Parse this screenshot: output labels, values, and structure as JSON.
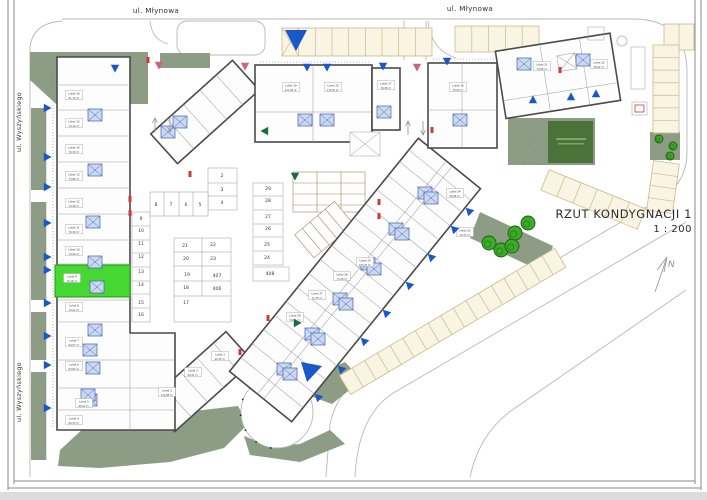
{
  "title": {
    "text": "RZUT KONDYGNACJI 1",
    "scale": "1 : 200"
  },
  "north_label": "N",
  "streets": {
    "top": [
      "ul. Młynowa",
      "ul. Młynowa"
    ],
    "left": [
      "ul. Wyszyńskiego",
      "ul. Wyszyńskiego"
    ]
  },
  "colors": {
    "accent_blue": "#1a57c8",
    "highlight_green": "#46d832",
    "sage_green": "#8d9c84",
    "parking_cream": "#faf5e2",
    "marker_pink": "#c9628f",
    "marker_dark_green": "#1b6b40",
    "door_red": "#d03a30"
  },
  "parking": {
    "numbers": [
      {
        "n": "2",
        "x": 222,
        "y": 177
      },
      {
        "n": "3",
        "x": 222,
        "y": 191
      },
      {
        "n": "4",
        "x": 222,
        "y": 204
      },
      {
        "n": "5",
        "x": 200,
        "y": 206
      },
      {
        "n": "6",
        "x": 186,
        "y": 206
      },
      {
        "n": "7",
        "x": 171,
        "y": 206
      },
      {
        "n": "8",
        "x": 156,
        "y": 206
      },
      {
        "n": "9",
        "x": 141,
        "y": 220
      },
      {
        "n": "10",
        "x": 141,
        "y": 232
      },
      {
        "n": "11",
        "x": 141,
        "y": 245
      },
      {
        "n": "12",
        "x": 141,
        "y": 258
      },
      {
        "n": "13",
        "x": 141,
        "y": 273
      },
      {
        "n": "14",
        "x": 141,
        "y": 286
      },
      {
        "n": "15",
        "x": 141,
        "y": 304
      },
      {
        "n": "16",
        "x": 141,
        "y": 316
      },
      {
        "n": "17",
        "x": 186,
        "y": 304
      },
      {
        "n": "18",
        "x": 186,
        "y": 289
      },
      {
        "n": "19",
        "x": 187,
        "y": 276
      },
      {
        "n": "20",
        "x": 186,
        "y": 260
      },
      {
        "n": "21",
        "x": 185,
        "y": 247
      },
      {
        "n": "22",
        "x": 213,
        "y": 246
      },
      {
        "n": "23",
        "x": 213,
        "y": 260
      },
      {
        "n": "24",
        "x": 267,
        "y": 259
      },
      {
        "n": "25",
        "x": 267,
        "y": 246
      },
      {
        "n": "26",
        "x": 268,
        "y": 230
      },
      {
        "n": "27",
        "x": 268,
        "y": 218
      },
      {
        "n": "28",
        "x": 268,
        "y": 202
      },
      {
        "n": "29",
        "x": 268,
        "y": 190
      },
      {
        "n": "406",
        "x": 217,
        "y": 290
      },
      {
        "n": "407",
        "x": 217,
        "y": 277
      },
      {
        "n": "408",
        "x": 270,
        "y": 275
      }
    ]
  },
  "unit_labels": [
    {
      "name": "Lokal 16",
      "area": "81,74 m²",
      "x": 74,
      "y": 96
    },
    {
      "name": "Lokal 15",
      "area": "70,16 m²",
      "x": 74,
      "y": 124
    },
    {
      "name": "Lokal 14",
      "area": "70,30 m²",
      "x": 74,
      "y": 150
    },
    {
      "name": "Lokal 13",
      "area": "73,86 m²",
      "x": 74,
      "y": 177
    },
    {
      "name": "Lokal 12",
      "area": "70,26 m²",
      "x": 74,
      "y": 204
    },
    {
      "name": "Lokal 11",
      "area": "70,30 m²",
      "x": 74,
      "y": 230
    },
    {
      "name": "Lokal 10",
      "area": "70,26 m²",
      "x": 74,
      "y": 252
    },
    {
      "name": "Lokal 9",
      "area": "70,16 m²",
      "x": 72,
      "y": 279
    },
    {
      "name": "Lokal 8",
      "area": "70,21 m²",
      "x": 74,
      "y": 308
    },
    {
      "name": "Lokal 7",
      "area": "64,07 m²",
      "x": 74,
      "y": 343
    },
    {
      "name": "Lokal 6",
      "area": "63,81 m²",
      "x": 74,
      "y": 367
    },
    {
      "name": "Lokal 5",
      "area": "98,22 m²",
      "x": 84,
      "y": 404
    },
    {
      "name": "Lokal 4",
      "area": "66,33 m²",
      "x": 74,
      "y": 421
    },
    {
      "name": "Lokal 1",
      "area": "112,88 m²",
      "x": 167,
      "y": 393
    },
    {
      "name": "Lokal 2",
      "area": "92,91 m²",
      "x": 193,
      "y": 373
    },
    {
      "name": "Lokal 3",
      "area": "90,15 m²",
      "x": 220,
      "y": 357
    },
    {
      "name": "Lokal 26",
      "area": "59,84 m²",
      "x": 295,
      "y": 318
    },
    {
      "name": "Lokal 27",
      "area": "71,35 m²",
      "x": 317,
      "y": 296
    },
    {
      "name": "Lokal 28",
      "area": "73,16 m²",
      "x": 342,
      "y": 277
    },
    {
      "name": "Lokal 29",
      "area": "103,97 m²",
      "x": 365,
      "y": 263
    },
    {
      "name": "Lokal 23",
      "area": "22,71 m²",
      "x": 465,
      "y": 233
    },
    {
      "name": "Lokal 24",
      "area": "40,96 m²",
      "x": 455,
      "y": 194
    },
    {
      "name": "Lokal 19",
      "area": "127,04 m²",
      "x": 291,
      "y": 88
    },
    {
      "name": "Lokal 20",
      "area": "132,87 m²",
      "x": 333,
      "y": 88
    },
    {
      "name": "Lokal 17",
      "area": "34,36 m²",
      "x": 386,
      "y": 86
    },
    {
      "name": "Lokal 18",
      "area": "75,50 m²",
      "x": 458,
      "y": 88
    },
    {
      "name": "Lokal 21",
      "area": "74,08 m²",
      "x": 542,
      "y": 67
    },
    {
      "name": "Lokal 22",
      "area": "58,92 m²",
      "x": 599,
      "y": 65
    }
  ],
  "markers": {
    "blue_triangles": [
      {
        "x": 47,
        "y": 108,
        "rot": -90
      },
      {
        "x": 47,
        "y": 157,
        "rot": -90
      },
      {
        "x": 47,
        "y": 187,
        "rot": -90
      },
      {
        "x": 47,
        "y": 223,
        "rot": -90
      },
      {
        "x": 47,
        "y": 257,
        "rot": -90
      },
      {
        "x": 47,
        "y": 270,
        "rot": -90
      },
      {
        "x": 47,
        "y": 303,
        "rot": -90
      },
      {
        "x": 47,
        "y": 336,
        "rot": -90
      },
      {
        "x": 47,
        "y": 365,
        "rot": -90
      },
      {
        "x": 47,
        "y": 408,
        "rot": -90
      },
      {
        "x": 115,
        "y": 68,
        "rot": 0
      },
      {
        "x": 307,
        "y": 67,
        "rot": 0
      },
      {
        "x": 327,
        "y": 67,
        "rot": 0
      },
      {
        "x": 383,
        "y": 66,
        "rot": 0
      },
      {
        "x": 447,
        "y": 61,
        "rot": 0
      },
      {
        "x": 533,
        "y": 100,
        "rot": 180
      },
      {
        "x": 571,
        "y": 97,
        "rot": 180
      },
      {
        "x": 596,
        "y": 94,
        "rot": 180
      },
      {
        "x": 469,
        "y": 211,
        "rot": 135
      },
      {
        "x": 454,
        "y": 229,
        "rot": 135
      },
      {
        "x": 431,
        "y": 257,
        "rot": 135
      },
      {
        "x": 409,
        "y": 285,
        "rot": 135
      },
      {
        "x": 386,
        "y": 313,
        "rot": 135
      },
      {
        "x": 364,
        "y": 341,
        "rot": 135
      },
      {
        "x": 341,
        "y": 369,
        "rot": 135
      },
      {
        "x": 318,
        "y": 397,
        "rot": 135
      }
    ],
    "pink_triangles": [
      {
        "x": 159,
        "y": 65,
        "rot": 0
      },
      {
        "x": 245,
        "y": 66,
        "rot": 0
      },
      {
        "x": 417,
        "y": 67,
        "rot": 0
      }
    ],
    "green_triangles": [
      {
        "x": 265,
        "y": 131,
        "rot": 90
      },
      {
        "x": 295,
        "y": 176,
        "rot": 0
      },
      {
        "x": 297,
        "y": 323,
        "rot": -90
      }
    ],
    "solid_triangles": [
      {
        "pts": "285,30 307,30 296,51"
      },
      {
        "pts": "301,362 322,366 307,382"
      }
    ]
  },
  "trees": [
    {
      "x": 489,
      "y": 243,
      "r": 7
    },
    {
      "x": 501,
      "y": 250,
      "r": 7
    },
    {
      "x": 512,
      "y": 246,
      "r": 7
    },
    {
      "x": 515,
      "y": 233,
      "r": 7
    },
    {
      "x": 528,
      "y": 223,
      "r": 7
    },
    {
      "x": 659,
      "y": 139,
      "r": 4
    },
    {
      "x": 673,
      "y": 146,
      "r": 4
    },
    {
      "x": 670,
      "y": 156,
      "r": 4
    }
  ]
}
